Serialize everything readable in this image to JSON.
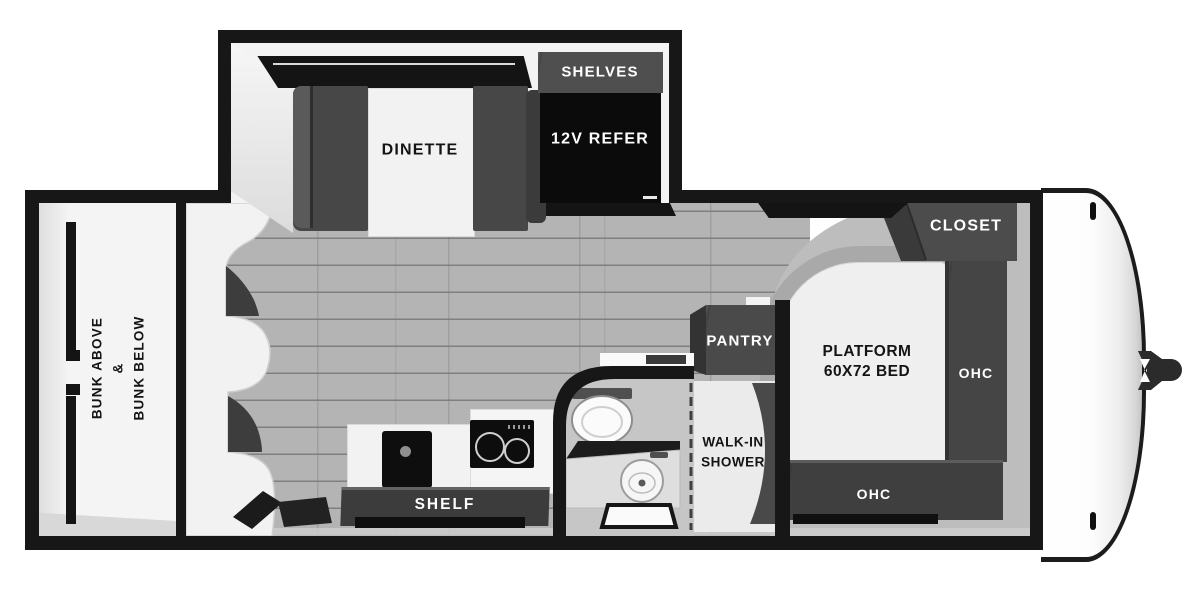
{
  "plan": {
    "type": "travel-trailer floor plan",
    "slideout": {
      "dinette": "DINETTE",
      "shelves": "SHELVES",
      "refrigerator": "12V REFER"
    },
    "bunk_room": {
      "line1": "BUNK ABOVE",
      "line2": "&",
      "line3": "BUNK BELOW"
    },
    "kitchen": {
      "shelf": "SHELF"
    },
    "bathroom": {
      "pantry": "PANTRY",
      "shower_line1": "WALK-IN",
      "shower_line2": "SHOWER"
    },
    "bedroom": {
      "closet": "CLOSET",
      "bed_line1": "PLATFORM",
      "bed_line2": "60X72 BED",
      "ohc_side": "OHC",
      "ohc_foot": "OHC"
    },
    "colors": {
      "wall": "#171717",
      "furniture_dark": "#474747",
      "refrigerator": "#0b0b0b",
      "floor_plank": "#b4b4b4",
      "floor_bedroom": "#bdbdbd",
      "label_on_dark": "#ffffff",
      "label_on_light": "#141414"
    }
  }
}
